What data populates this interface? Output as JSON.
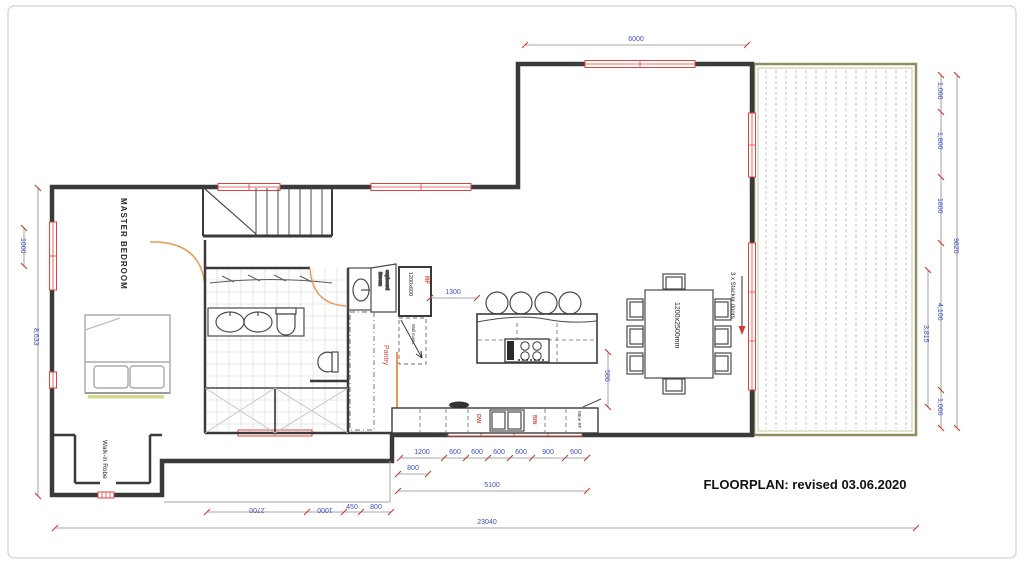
{
  "title": "FLOORPLAN: revised 03.06.2020",
  "labels": {
    "master_bedroom": "MASTER BEDROOM",
    "walk_in_robe": "Walk-in Robe",
    "pantry": "Pantry",
    "broom_line1": "Broom",
    "broom_line2": "cupboard",
    "rf": "RF",
    "rf_size": "1200x600",
    "wall_ovens": "Wall ovens",
    "dw": "DW",
    "bin": "BIN",
    "wine_rf": "Wine RF",
    "table_size": "1200x2500mm",
    "stacker_doors": "3 x Stacker doors"
  },
  "dims": {
    "top_width": "6000",
    "right_outer": "9820",
    "right_chain": [
      "1,000",
      "1,800",
      "1800",
      "4,100",
      "1,000"
    ],
    "right_inner": "3,815",
    "left_total": "8,633",
    "left_window": "1000",
    "island_gap": "1300",
    "island_right": "500",
    "bench_chain": [
      "1200",
      "600",
      "600",
      "600",
      "600",
      "900",
      "600"
    ],
    "bench_800": "800",
    "bench_total": "5100",
    "entry_chain": [
      "2700",
      "1000",
      "450",
      "800"
    ],
    "overall": "23040"
  },
  "colors": {
    "wall": "#3a3a3a",
    "window": "#e0433d",
    "door": "#ee9550",
    "dim_text": "#3f4ec4",
    "tick": "#c23b32",
    "deck_border": "#8e8e62",
    "deck_slat": "#bcbcbc"
  }
}
